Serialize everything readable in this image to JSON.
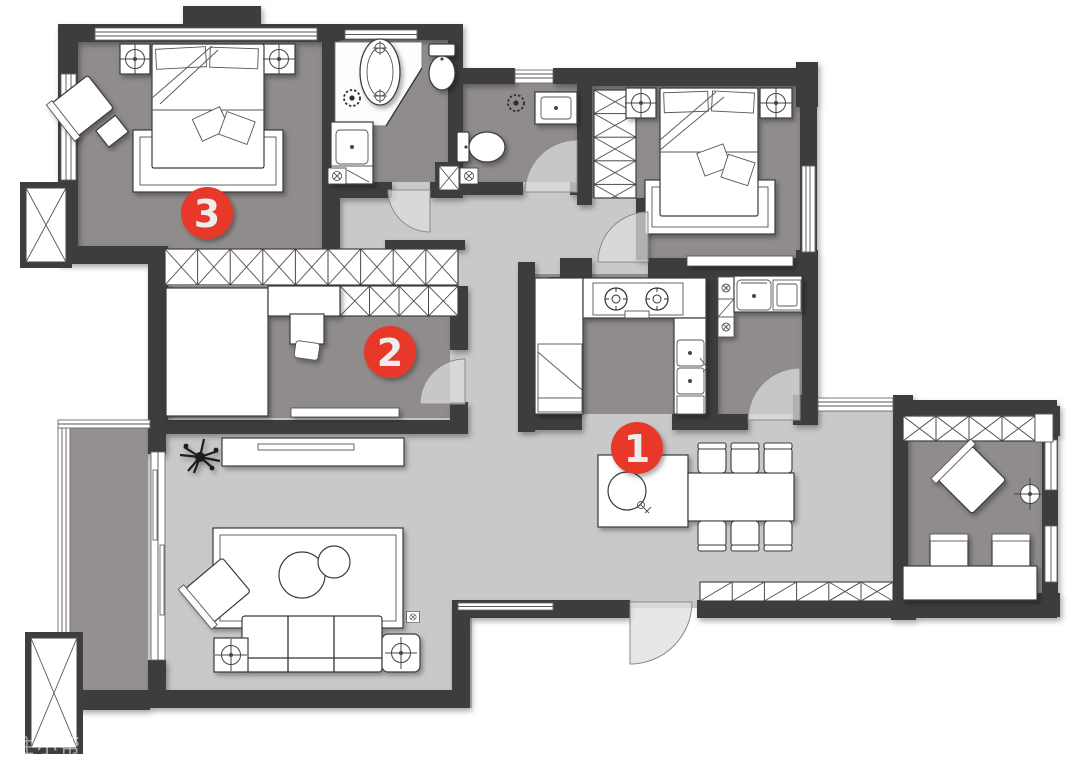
{
  "plan": {
    "markers": [
      {
        "label": "1"
      },
      {
        "label": "2"
      },
      {
        "label": "3"
      }
    ],
    "watermark": "住小帮@设计馆",
    "colors": {
      "wall": "#3e3e3e",
      "room_floor": "#8f8c8b",
      "public_floor": "#c9c9c9",
      "balcony_floor": "#949190",
      "furniture": "#ffffff",
      "marker": "#e7372c",
      "marker_text": "#ededed",
      "outline": "#3a3a3a"
    },
    "icons": [
      "ceiling-lamp-icon",
      "exhaust-fan-icon",
      "floor-drain-icon",
      "gas-stove-icon",
      "kitchen-sink-icon",
      "island-sink-icon",
      "laundry-sink-icon",
      "washing-machine-icon",
      "toilet-icon",
      "bathtub-icon",
      "wash-basin-icon",
      "plant-icon",
      "sofa-icon",
      "bed-icon",
      "dining-table-icon",
      "desk-icon",
      "wardrobe-icon",
      "shaft-icon",
      "door-swing-icon",
      "window-icon"
    ]
  }
}
